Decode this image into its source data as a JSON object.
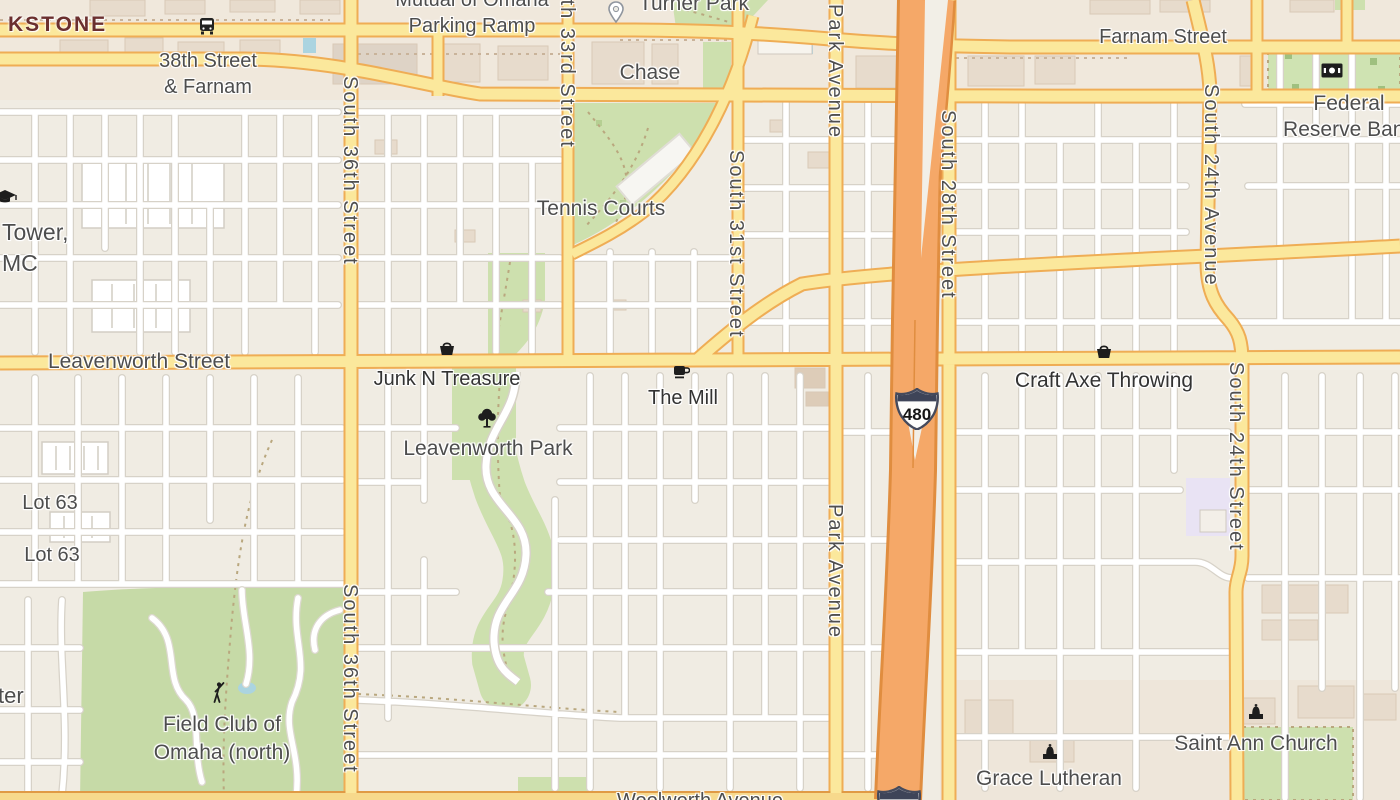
{
  "district": {
    "text": "KSTONE",
    "color": "#6b2f2e"
  },
  "transit_stop": {
    "lines": [
      "38th Street",
      "& Farnam"
    ],
    "icon": "bus-icon"
  },
  "marker": {
    "icon": "map-pin-icon"
  },
  "route_shield": {
    "text": "480",
    "type": "interstate",
    "band_color": "#3e4458"
  },
  "streets": [
    {
      "text": "Farnam Street",
      "orientation": "horizontal"
    },
    {
      "text": "Leavenworth Street",
      "orientation": "horizontal"
    },
    {
      "text": "Woolworth Avenue",
      "orientation": "horizontal"
    },
    {
      "text": "South 36th Street",
      "orientation": "vertical"
    },
    {
      "text": "South 36th Street",
      "orientation": "vertical"
    },
    {
      "text": "South 33rd Street",
      "orientation": "vertical"
    },
    {
      "text": "South 31st Street",
      "orientation": "vertical"
    },
    {
      "text": "Park Avenue",
      "orientation": "vertical"
    },
    {
      "text": "Park Avenue",
      "orientation": "vertical"
    },
    {
      "text": "South 28th Street",
      "orientation": "vertical"
    },
    {
      "text": "South 24th Avenue",
      "orientation": "vertical"
    },
    {
      "text": "South 24th Street",
      "orientation": "vertical"
    }
  ],
  "places": [
    {
      "lines": [
        "Mutual of Omaha",
        "Parking Ramp"
      ],
      "icon": null
    },
    {
      "lines": [
        "Turner Park"
      ],
      "icon": null
    },
    {
      "lines": [
        "Chase"
      ],
      "icon": null
    },
    {
      "lines": [
        "Tennis Courts"
      ],
      "icon": null
    },
    {
      "lines": [
        "Tower,",
        "MC"
      ],
      "icon": "graduation-cap-icon"
    },
    {
      "lines": [
        "Junk N Treasure"
      ],
      "icon": "shopping-basket-icon"
    },
    {
      "lines": [
        "The Mill"
      ],
      "icon": "coffee-cup-icon"
    },
    {
      "lines": [
        "Craft Axe Throwing"
      ],
      "icon": "shopping-basket-icon"
    },
    {
      "lines": [
        "Leavenworth Park"
      ],
      "icon": "tree-icon"
    },
    {
      "lines": [
        "Lot 63"
      ],
      "icon": null
    },
    {
      "lines": [
        "Lot 63"
      ],
      "icon": null
    },
    {
      "lines": [
        "ter"
      ],
      "icon": null
    },
    {
      "lines": [
        "Field Club of",
        "Omaha (north)"
      ],
      "icon": "golfer-icon"
    },
    {
      "lines": [
        "Grace Lutheran"
      ],
      "icon": "church-icon"
    },
    {
      "lines": [
        "Saint Ann Church"
      ],
      "icon": "church-icon"
    },
    {
      "lines": [
        "Federal",
        "Reserve Bank"
      ],
      "icon": "banknote-icon"
    }
  ],
  "colors": {
    "land": "#f1eee6",
    "road_minor": "#ffffff",
    "road_yellow": "#fbe89c",
    "road_yellow_casing": "#efad55",
    "highway_orange": "#f5a868",
    "highway_casing": "#e08d3f",
    "park_green": "#cde0ae",
    "water_blue": "#abd4e0",
    "landuse_purple": "#e9e3f4",
    "street_label": "#4d4d4d",
    "poi_label": "#333333",
    "district_label": "#6b2f2e"
  }
}
